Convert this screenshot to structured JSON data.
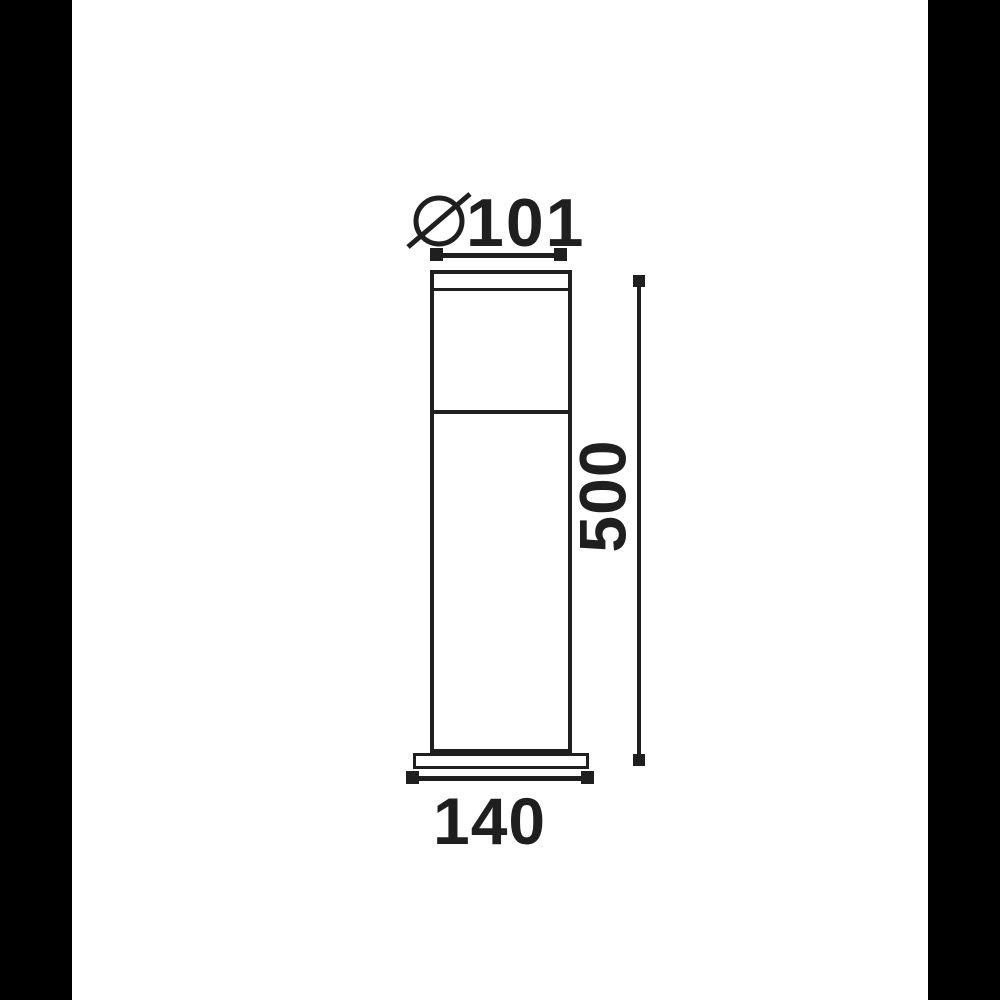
{
  "page": {
    "background_color": "#ffffff",
    "pillarbox_color": "#000000",
    "stroke_color": "#1f1f1f"
  },
  "drawing": {
    "type": "technical-dimension-drawing",
    "dimensions": {
      "diameter": {
        "symbol": "⌀",
        "value": "101"
      },
      "height": {
        "value": "500"
      },
      "base_width": {
        "value": "140"
      }
    }
  }
}
